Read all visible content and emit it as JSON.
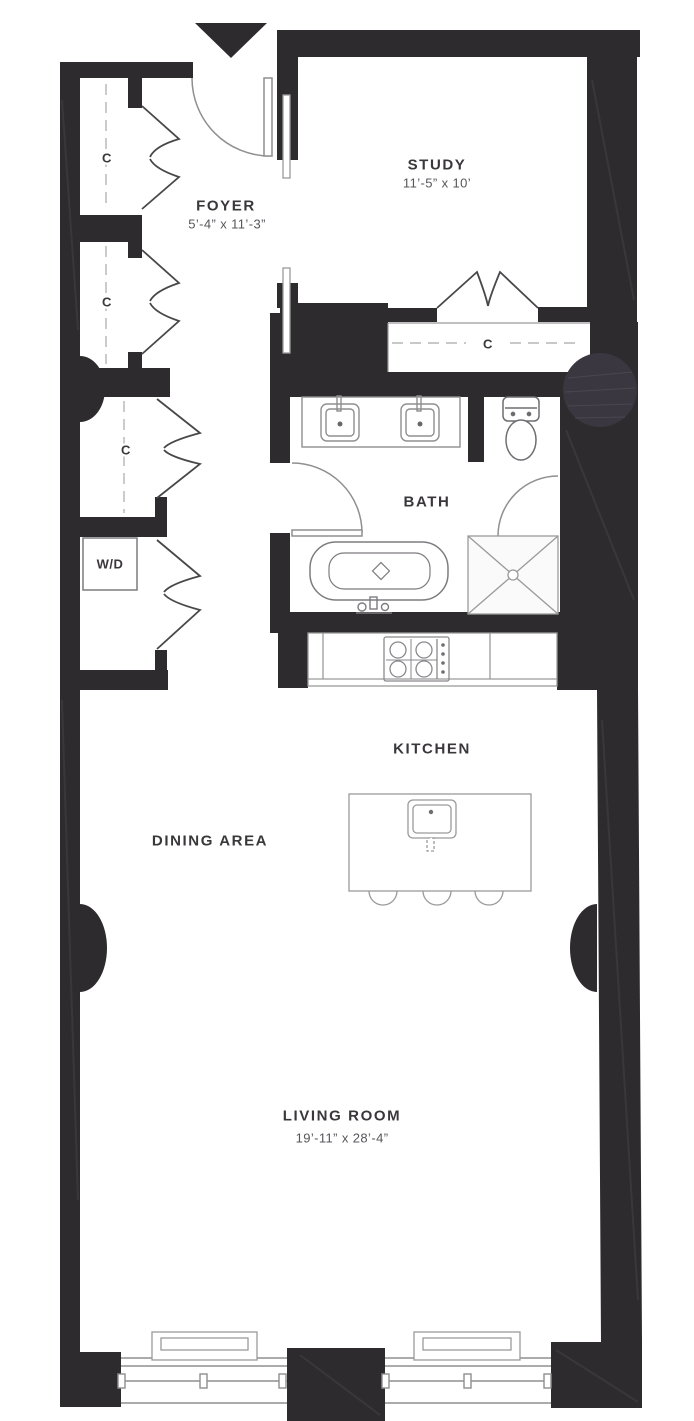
{
  "floorplan": {
    "rooms": {
      "foyer": {
        "name": "FOYER",
        "dims": "5’-4” x 11’-3”"
      },
      "study": {
        "name": "STUDY",
        "dims": "11’-5” x 10’"
      },
      "bath": {
        "name": "BATH"
      },
      "kitchen": {
        "name": "KITCHEN"
      },
      "dining": {
        "name": "DINING AREA"
      },
      "living": {
        "name": "LIVING ROOM",
        "dims": "19’-11” x 28’-4”"
      }
    },
    "closet_label": "C",
    "washer_dryer_label": "W/D",
    "colors": {
      "wall": "#2e2b2f",
      "column": "#3a3740",
      "fixture_line": "#8f8f8f",
      "room_text": "#3a373b",
      "dim_text": "#57555a",
      "background": "#ffffff"
    }
  }
}
